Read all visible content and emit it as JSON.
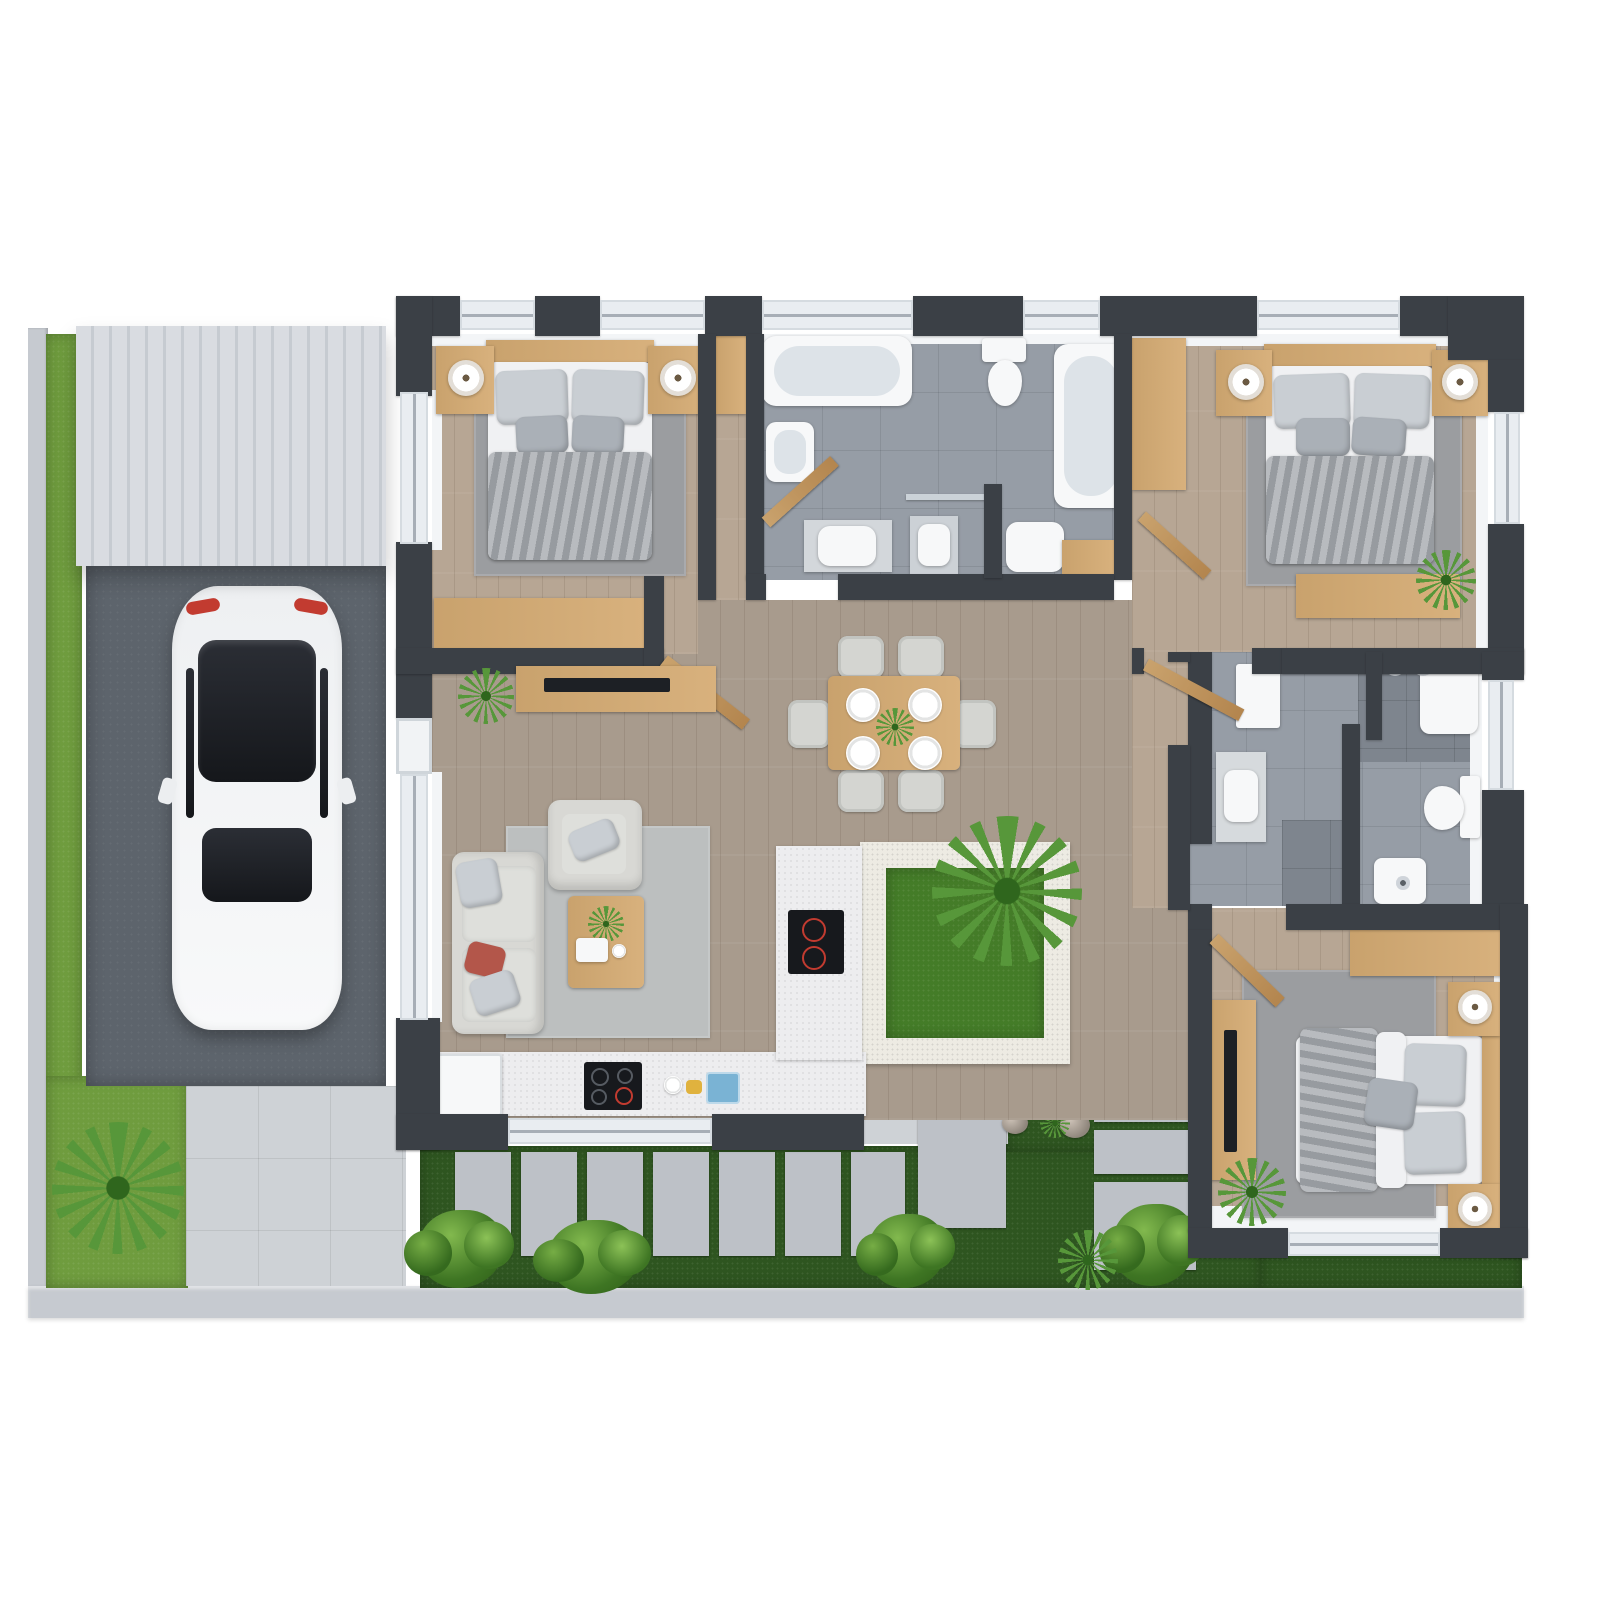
{
  "meta": {
    "title": "3D top-view floor plan render of a 3-bedroom house",
    "canvas": {
      "width": 1600,
      "height": 1600
    },
    "style": "photoreal 3D architectural plan, white background"
  },
  "palette": {
    "bg": "#ffffff",
    "wall": "#3b4046",
    "lining": "#f3f5f7",
    "window_glass": "#e9edf1",
    "window_rail": "#a7aeb6",
    "floor_open": "#a89b8d",
    "floor_bedroom": "#b7a694",
    "tile": "#969da6",
    "tile_dark": "#7e858e",
    "wood": "#c9a26d",
    "counter": "#ededef",
    "court_border": "#edebe3",
    "white_fix": "#f7f8f9",
    "fix_inner": "#dde3e8",
    "sofa": "#d8d8d4",
    "cushion": "#c9ced3",
    "cushion_dark": "#aab0b7",
    "pillow_red": "#b3564a",
    "blanket": "#a4a8ad",
    "sheet": "#f0f1f3",
    "rug": "#a3a5a5",
    "rug_light": "#bcbfbf",
    "grass_left": "#6f9c3e",
    "grass_court": "#447c28",
    "grass_dark": "#2e5520",
    "plant": "#57973a",
    "plant_dark": "#2f661d",
    "paver": "#bdc1c7",
    "pave_light": "#ced2d6",
    "driveway": "#5d646c",
    "carport": "#d9dce1",
    "curb": "#c6cad0",
    "car_body": "#f2f4f6",
    "car_glass": "#23262c",
    "tail_red": "#c23b30",
    "cooktop": "#17191d",
    "chrome": "#c9ced4"
  },
  "scene": {
    "site": [
      "left-lawn-strip",
      "left-curb",
      "corner-lawn-with-palm",
      "carport-roof",
      "driveway",
      "white-car",
      "front-walkway",
      "rear-garden-lawn",
      "stepping-stone-path",
      "stone-slabs",
      "rock-garden",
      "shrubs"
    ],
    "rooms": [
      {
        "id": "bedroom-1",
        "area": "top-left",
        "furniture": [
          "double-bed",
          "two-nightstands",
          "table-lamps",
          "area-rug",
          "low-wardrobe",
          "tv-console",
          "potted-plant"
        ]
      },
      {
        "id": "bathroom-1",
        "area": "top-center",
        "furniture": [
          "bathtub",
          "second-bathtub",
          "toilet",
          "bidet",
          "double-vanity",
          "glass-shower-screen",
          "swing-door"
        ]
      },
      {
        "id": "bedroom-2",
        "area": "top-right",
        "furniture": [
          "double-bed",
          "two-nightstands",
          "table-lamps",
          "area-rug",
          "wardrobe",
          "dresser",
          "palm-plant"
        ]
      },
      {
        "id": "living-room",
        "area": "center-left",
        "furniture": [
          "two-seat-sofa",
          "armchair",
          "coffee-table",
          "plant",
          "tray",
          "area-rug",
          "red-accent-pillow"
        ]
      },
      {
        "id": "dining-area",
        "area": "center",
        "furniture": [
          "six-seat-dining-table",
          "four-plates",
          "green-centerpiece"
        ]
      },
      {
        "id": "kitchen",
        "area": "bottom-center-left",
        "furniture": [
          "straight-counter",
          "fridge",
          "induction-hob",
          "island-counter",
          "island-hob",
          "small-wares"
        ]
      },
      {
        "id": "courtyard",
        "area": "center-right",
        "furniture": [
          "stone-border",
          "lawn",
          "palm-tree"
        ]
      },
      {
        "id": "bathroom-2",
        "area": "right",
        "furniture": [
          "walk-in-shower",
          "shower-heads",
          "vanity-sink",
          "toilet",
          "partition-walls",
          "storage-box"
        ]
      },
      {
        "id": "bedroom-3",
        "area": "bottom-right",
        "furniture": [
          "double-bed-horizontal",
          "two-nightstands",
          "table-lamps",
          "area-rug",
          "wardrobe",
          "tv-console",
          "palm-plant"
        ]
      },
      {
        "id": "hallway",
        "area": "center-right-strip",
        "furniture": [
          "swing-doors"
        ]
      }
    ]
  }
}
